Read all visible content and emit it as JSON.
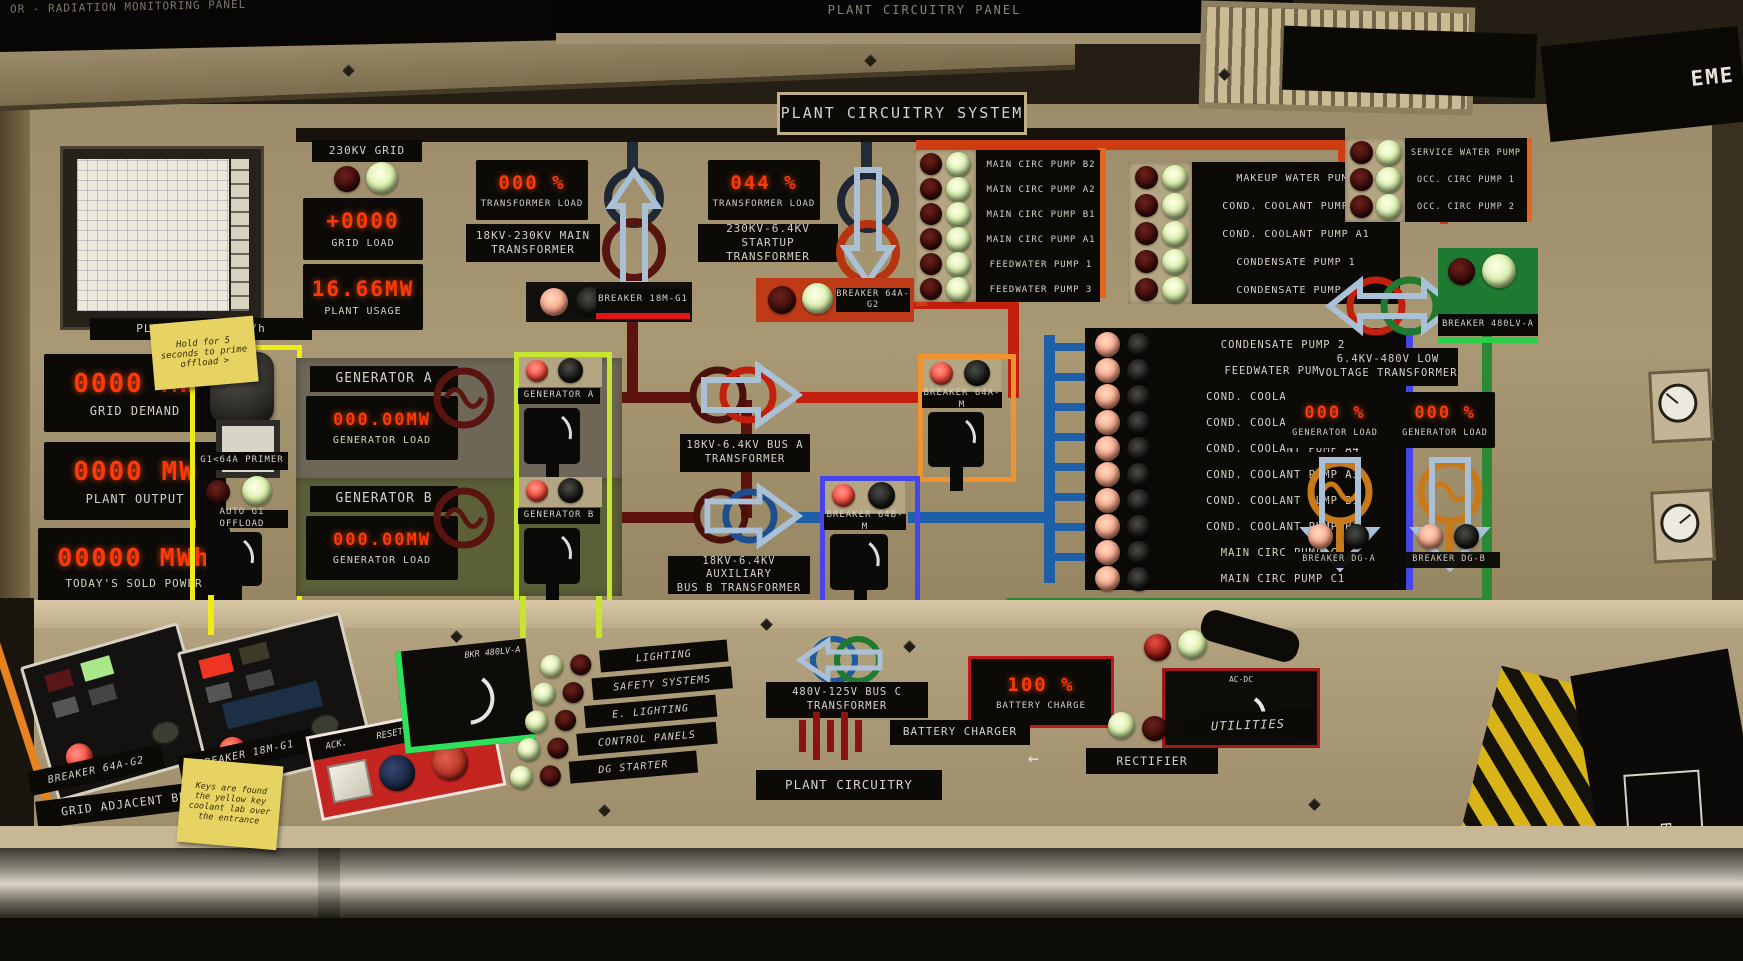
{
  "colors": {
    "wall": "#a3926f",
    "panel_dark": "#0b0a07",
    "seg_red": "#ff3808",
    "wire_darkred": "#5c120d",
    "wire_red": "#c21f0c",
    "wire_orange": "#cf3c12",
    "wire_blue": "#1f5fa8",
    "wire_green": "#2c8a36",
    "outline_yellow": "#f0ea18",
    "outline_yellowgreen": "#c6e52e",
    "outline_orange": "#f0922e",
    "outline_blue": "#4646e8",
    "arrow_lightblue": "#a9c0d6"
  },
  "screens": {
    "left": "OR - RADIATION MONITORING PANEL",
    "center": "PLANT CIRCUITRY PANEL",
    "right_edge": "EME"
  },
  "title": "PLANT CIRCUITRY SYSTEM",
  "recorder": {
    "label": "PLANT OUTPUT  MW/h"
  },
  "grid": {
    "name": "230KV GRID",
    "load_value": "+0000",
    "load_label": "GRID LOAD",
    "usage_value": "16.66MW",
    "usage_label": "PLANT USAGE",
    "demand_value": "0000 MW",
    "demand_label": "GRID DEMAND",
    "output_value": "0000 MW",
    "output_label": "PLANT OUTPUT",
    "sold_value": "00000 MWh",
    "sold_label": "TODAY'S SOLD POWER"
  },
  "sticky_top": {
    "line1": "Hold for 5",
    "line2": "seconds to prime",
    "line3": "offload >"
  },
  "primer": {
    "label": "G1<64A PRIMER",
    "offload_label": "AUTO G1 OFFLOAD"
  },
  "generators": {
    "a": {
      "name": "GENERATOR A",
      "load_value": "000.00MW",
      "load_label": "GENERATOR LOAD"
    },
    "b": {
      "name": "GENERATOR B",
      "load_value": "000.00MW",
      "load_label": "GENERATOR LOAD"
    },
    "breaker_a": "GENERATOR A",
    "breaker_b": "GENERATOR B"
  },
  "transformers": {
    "main": {
      "load_value": "000 %",
      "load_label": "TRANSFORMER LOAD",
      "name": "18KV-230KV MAIN\nTRANSFORMER"
    },
    "startup": {
      "load_value": "044 %",
      "load_label": "TRANSFORMER LOAD",
      "name": "230KV-6.4KV STARTUP\nTRANSFORMER"
    },
    "bus_a": {
      "name": "18KV-6.4KV BUS A\nTRANSFORMER"
    },
    "bus_b": {
      "name": "18KV-6.4KV AUXILIARY\nBUS B TRANSFORMER"
    },
    "low_voltage": {
      "name": "6.4KV-480V LOW\nVOLTAGE TRANSFORMER"
    },
    "bus_c": {
      "name": "480V-125V BUS C\nTRANSFORMER"
    }
  },
  "breakers": {
    "b18mg1": "BREAKER 18M-G1",
    "b64ag2": "BREAKER 64A-G2",
    "b64am": "BREAKER 64A-M",
    "b64bm": "BREAKER 64B-M",
    "b480lva": "BREAKER 480LV-A",
    "dg_a": "BREAKER DG-A",
    "dg_b": "BREAKER DG-B"
  },
  "dg": {
    "a_load": "000 %",
    "a_label": "GENERATOR LOAD",
    "b_load": "000 %",
    "b_label": "GENERATOR LOAD"
  },
  "pumps": {
    "p1": [
      "MAIN CIRC PUMP B2",
      "MAIN CIRC PUMP A2",
      "MAIN CIRC PUMP B1",
      "MAIN CIRC PUMP A1",
      "FEEDWATER PUMP 1",
      "FEEDWATER PUMP 3"
    ],
    "p2": [
      "MAKEUP WATER PUMP",
      "COND. COOLANT PUMP A2",
      "COND. COOLANT PUMP A1",
      "CONDENSATE PUMP 1",
      "CONDENSATE PUMP 3"
    ],
    "p3": [
      "SERVICE WATER PUMP",
      "OCC. CIRC PUMP 1",
      "OCC. CIRC PUMP 2"
    ],
    "p4": [
      "CONDENSATE PUMP 2",
      "FEEDWATER PUMP 2",
      "COND. COOLANT PUMP B4",
      "COND. COOLANT PUMP B3",
      "COND. COOLANT PUMP A4",
      "COND. COOLANT PUMP A3",
      "COND. COOLANT PUMP B1",
      "COND. COOLANT PUMP B2",
      "MAIN CIRC PUMP C2",
      "MAIN CIRC PUMP C1"
    ]
  },
  "desk": {
    "console1": "BREAKER 64A-G2",
    "console2": "BREAKER 18M-G1",
    "grid_adjacent": "GRID ADJACENT BRK.",
    "sticky": {
      "line1": "Keys are found",
      "line2": "the yellow key",
      "line3": "coolant lab over",
      "line4": "the entrance"
    },
    "ack": "ACK.",
    "reset": "RESET.",
    "silence": "SILENCE",
    "bkr480": "BKR 480LV-A",
    "acdc": "AC-DC",
    "systems": [
      "LIGHTING",
      "SAFETY SYSTEMS",
      "E. LIGHTING",
      "CONTROL PANELS",
      "DG STARTER"
    ],
    "battery_value": "100 %",
    "battery_label": "BATTERY CHARGE",
    "battery_charger": "BATTERY CHARGER",
    "rectifier": "RECTIFIER",
    "rect_arrow": "←",
    "utilities": "UTILITIES",
    "plant_circuitry": "PLANT CIRCUITRY"
  },
  "emergency": "EMERGENCY"
}
